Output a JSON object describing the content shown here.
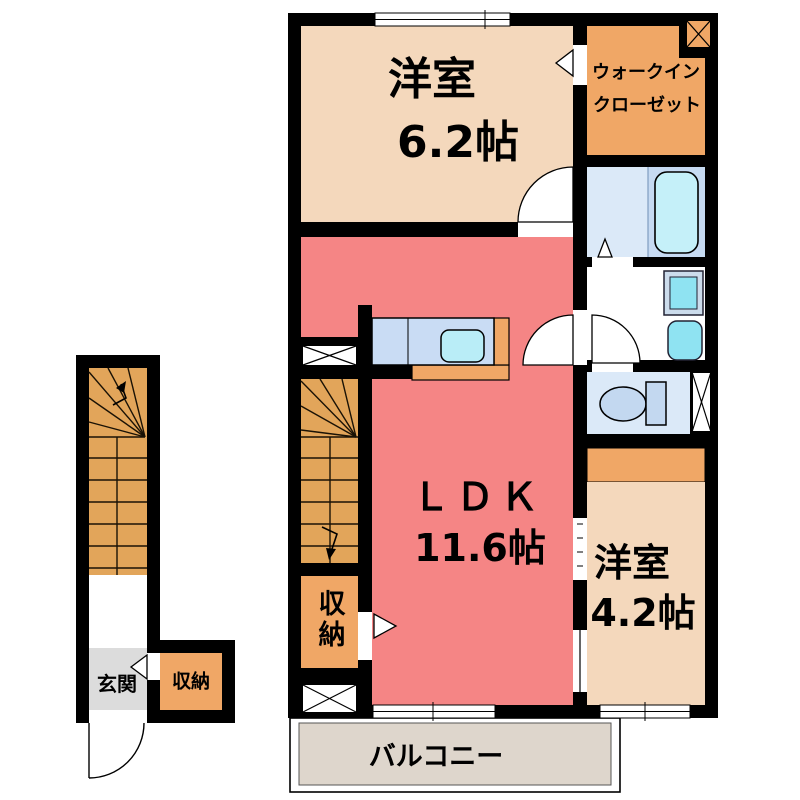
{
  "floorplan": {
    "unit": {
      "bedroom1": {
        "label": "洋室",
        "area": "6.2帖"
      },
      "walk_in_closet": {
        "label_line1": "ウォークイン",
        "label_line2": "クローゼット"
      },
      "ldk": {
        "label": "ＬＤＫ",
        "area": "11.6帖"
      },
      "bedroom2": {
        "label": "洋室",
        "area": "4.2帖"
      },
      "storage": {
        "label": "収納"
      },
      "balcony": {
        "label": "バルコニー"
      }
    },
    "stair_block": {
      "entrance": {
        "label": "玄関"
      },
      "storage": {
        "label": "収納"
      }
    },
    "colors": {
      "room_peach": "#F4D8BC",
      "closet_orange": "#F0A766",
      "stairs_orange": "#E2A55A",
      "ldk_salmon": "#F58585",
      "wet_area_blue": "#DBE9F8",
      "tub_zone_blue": "#C6DAF2",
      "fixture_cyan": "#8FE3F2",
      "tub_cyan": "#C5F0F9",
      "kitchen_counter_blue": "#C9DCF4",
      "entrance_gray": "#DCDCDC",
      "balcony_beige": "#DED6CC",
      "wall_black": "#000000"
    }
  }
}
